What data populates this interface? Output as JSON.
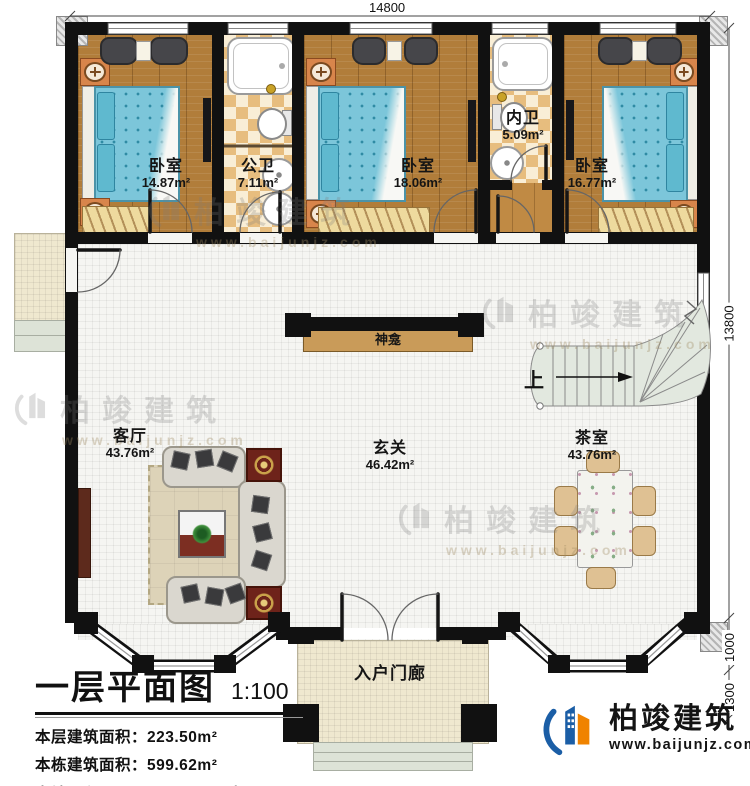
{
  "dimensions": {
    "width_top": "14800",
    "height_right": "13800",
    "seg_1000": "1000",
    "seg_1300": "1300"
  },
  "rooms": {
    "bedroom_left": {
      "name": "卧室",
      "area": "14.87m²"
    },
    "public_bath": {
      "name": "公卫",
      "area": "7.11m²"
    },
    "bedroom_mid": {
      "name": "卧室",
      "area": "18.06m²"
    },
    "inner_bath": {
      "name": "内卫",
      "area": "5.09m²"
    },
    "bedroom_right": {
      "name": "卧室",
      "area": "16.77m²"
    },
    "living_room": {
      "name": "客厅",
      "area": "43.76m²"
    },
    "foyer": {
      "name": "玄关",
      "area": "46.42m²"
    },
    "tea_room": {
      "name": "茶室",
      "area": "43.76m²"
    },
    "entry_porch": {
      "name": "入户门廊"
    },
    "shrine": {
      "name": "神龛"
    },
    "stair_direction": "上"
  },
  "title_block": {
    "title": "一层平面图",
    "scale": "1:100",
    "rows": [
      {
        "label": "本层建筑面积：",
        "value": "223.50m²"
      },
      {
        "label": "本栋建筑面积：",
        "value": "599.62m²"
      },
      {
        "label": "占地面积：",
        "value": "229.80m²",
        "label2": "层高：",
        "value2": "3.9m"
      }
    ]
  },
  "branding": {
    "company": "柏竣建筑",
    "website": "www.baijunjz.com"
  },
  "watermark": {
    "text": "柏竣建筑",
    "url": "www.baijunjz.com"
  },
  "colors": {
    "wall": "#111111",
    "wood_floor": "#b17d3a",
    "bed_blue": "#7cc6da",
    "logo_blue": "#1b5ea6",
    "logo_orange": "#f08300"
  }
}
